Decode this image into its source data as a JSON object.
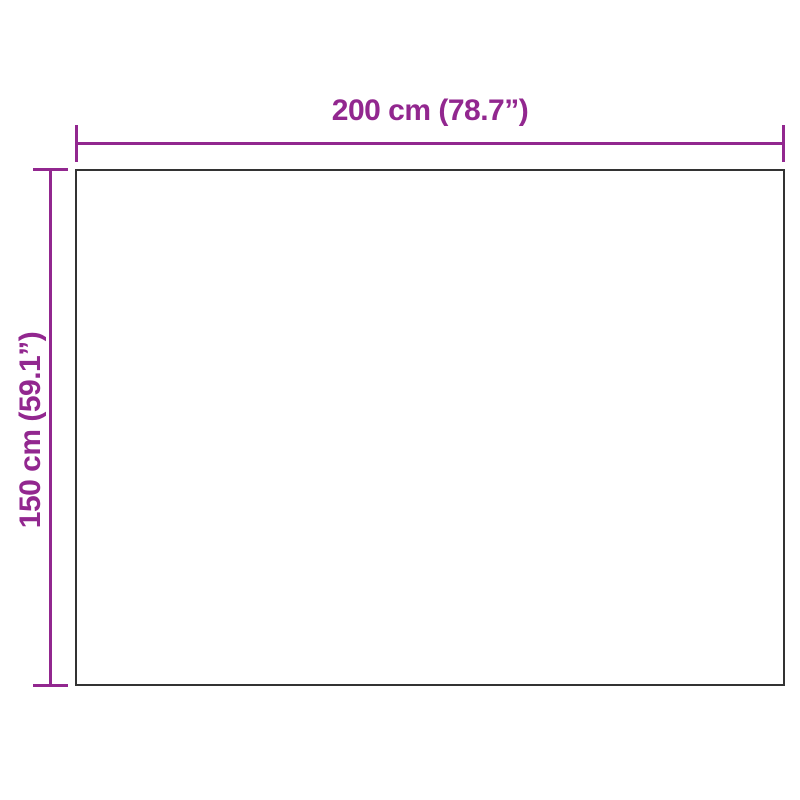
{
  "diagram": {
    "kind": "product-dimension-diagram",
    "background_color": "#ffffff",
    "accent_color": "#92278F",
    "outline_color": "#333333",
    "width_label": "200 cm (78.7”)",
    "height_label": "150 cm (59.1”)"
  }
}
